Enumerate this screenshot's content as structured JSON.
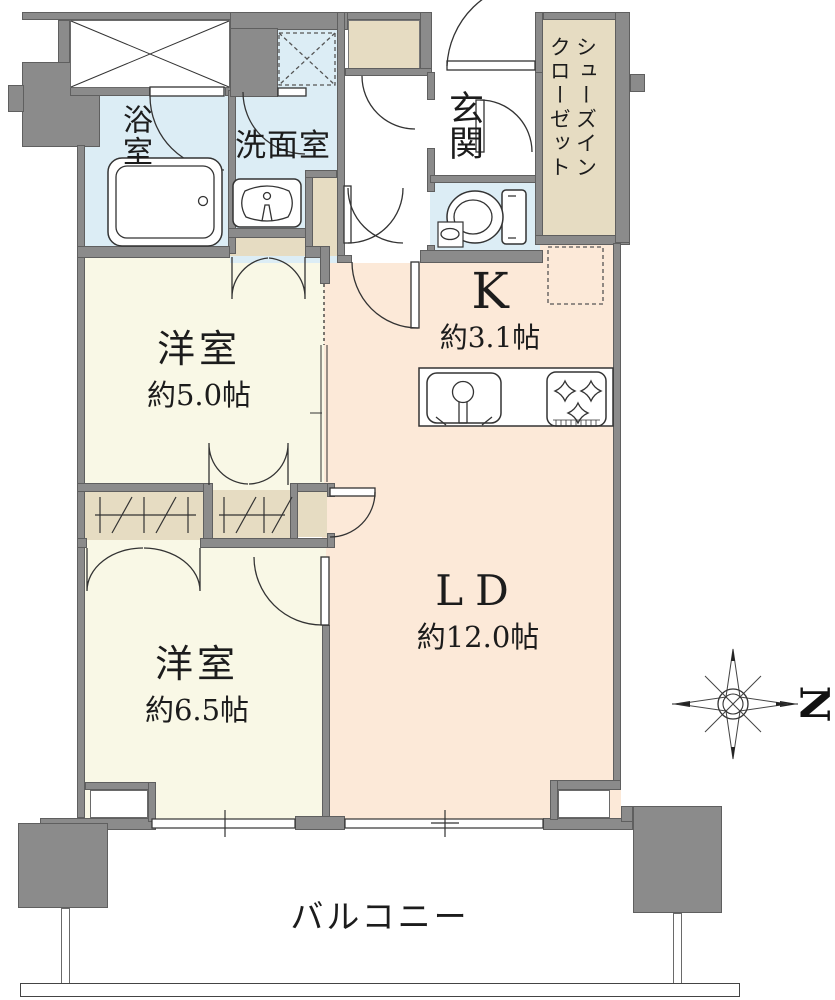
{
  "plan_title": "マンション間取り図",
  "rooms": {
    "bath": {
      "label": "浴室"
    },
    "washroom": {
      "label": "洗面室"
    },
    "entrance": {
      "label": "玄関"
    },
    "shoes_closet": {
      "line1": "シューズイン",
      "line2": "クローゼット"
    },
    "kitchen": {
      "label": "K",
      "area": "約3.1帖"
    },
    "bedroom5": {
      "label": "洋室",
      "area": "約5.0帖"
    },
    "bedroom6": {
      "label": "洋室",
      "area": "約6.5帖"
    },
    "living": {
      "label": "LD",
      "area": "約12.0帖"
    },
    "balcony": {
      "label": "バルコニー"
    }
  },
  "compass": {
    "north_label": "N"
  },
  "colors": {
    "wall": "#8b8b8b",
    "wet_room": "#dcedf5",
    "bedroom": "#f9f8e6",
    "living_kitchen": "#fce9d8",
    "closet": "#e6dcc2",
    "line": "#333333"
  }
}
